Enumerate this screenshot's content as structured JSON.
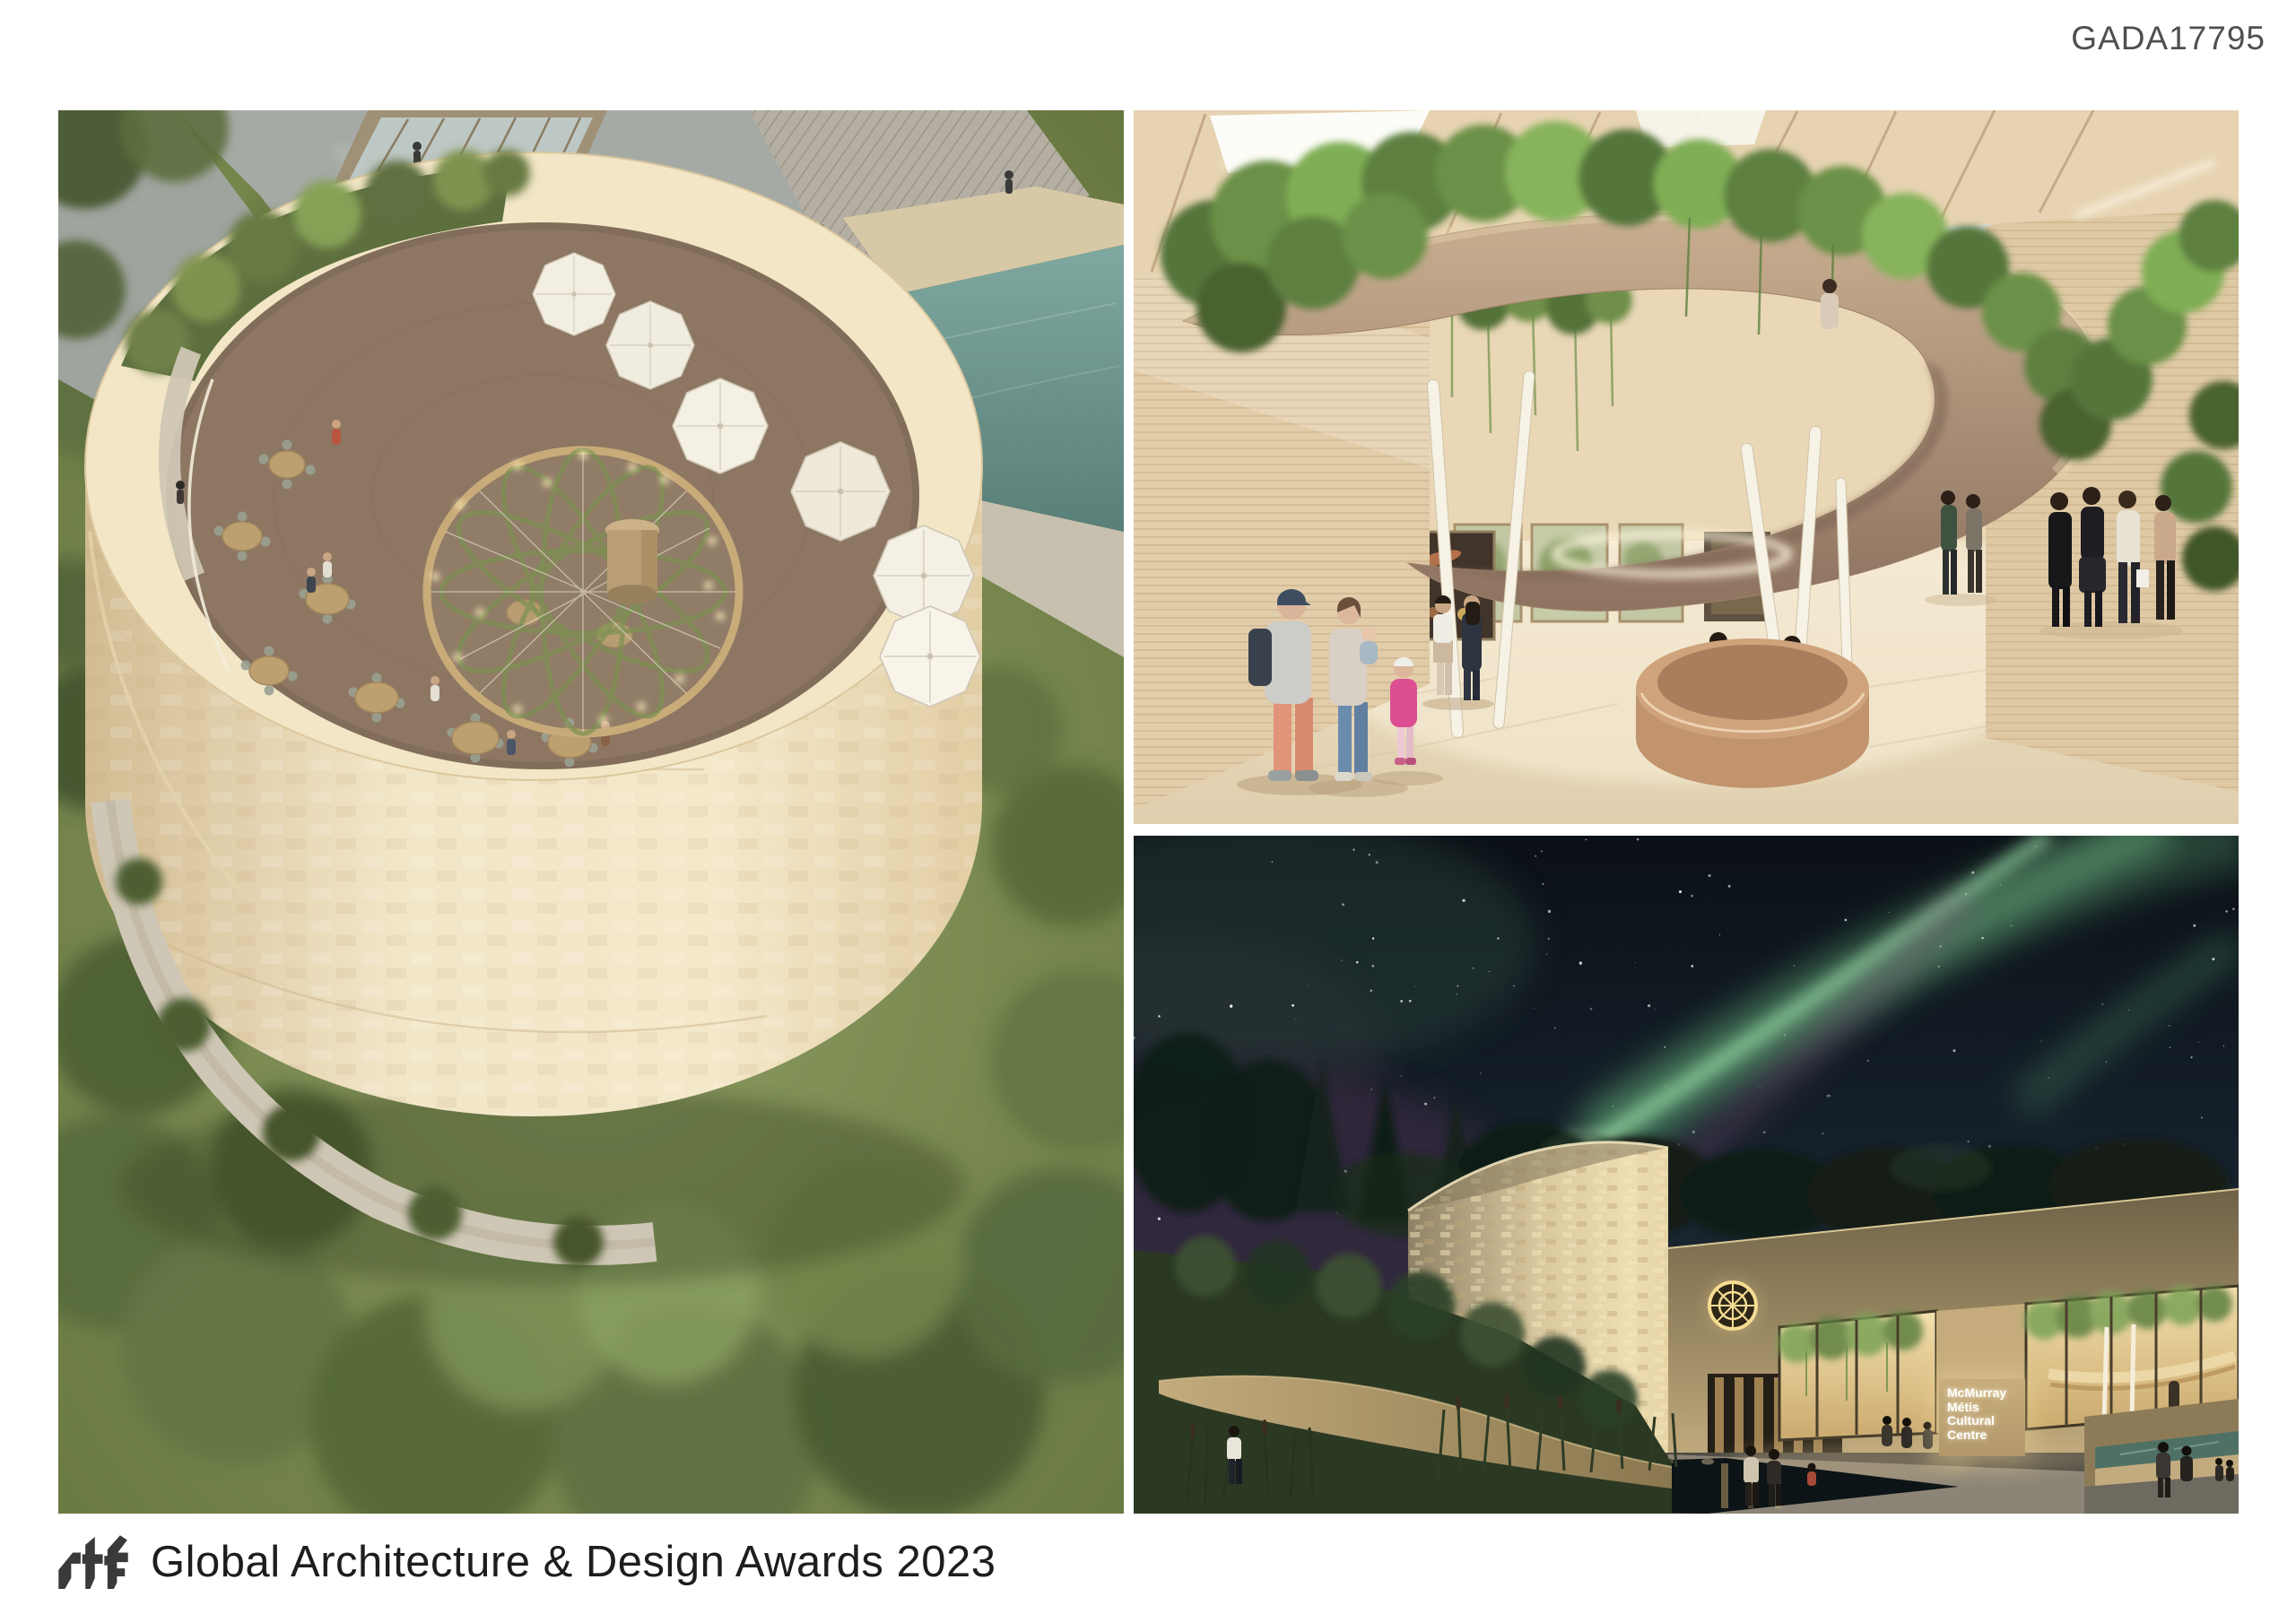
{
  "page": {
    "code": "GADA17795",
    "background": "#ffffff"
  },
  "footer": {
    "logo_text": "rtf",
    "title": "Global Architecture & Design Awards 2023"
  },
  "night_panel": {
    "sign_lines": [
      "McMurray",
      "Métis",
      "Cultural",
      "Centre"
    ]
  },
  "colors": {
    "code_text": "#4f4f4f",
    "footer_text": "#1d1d1b",
    "logo": "#3a3a38",
    "cream_wall": "#eadcba",
    "terrace_deck": "#8c7560",
    "foliage_green": "#6f8049",
    "pool_teal": "#6f9b94",
    "interior_wall": "#e4d0ae",
    "ramp_taupe": "#a98d74",
    "vine_green": "#7da152",
    "night_sky": "#141f26",
    "aurora_green": "#7ccb8e",
    "aurora_purple": "#7a4a74",
    "sign_wall": "#c2a878",
    "sign_text": "#ffffff"
  }
}
